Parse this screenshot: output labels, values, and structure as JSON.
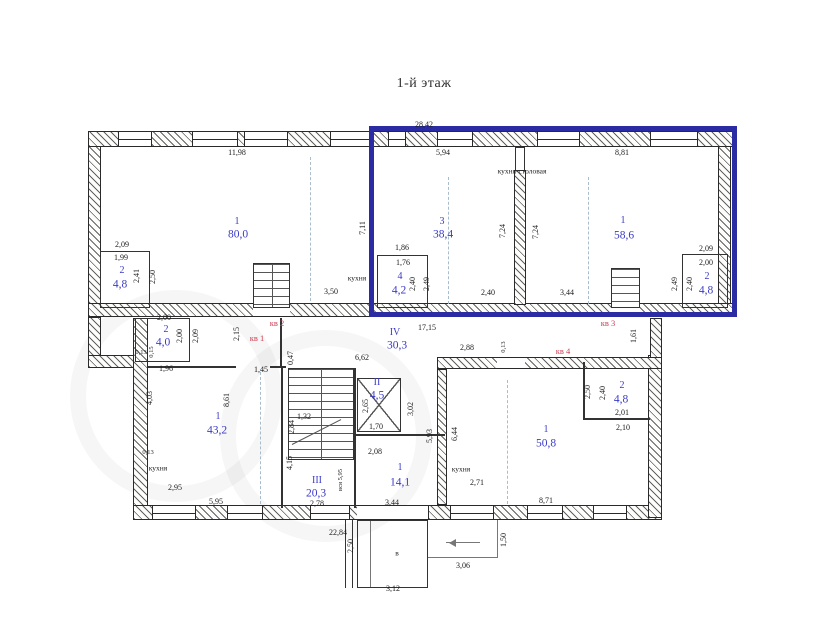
{
  "title": "1-й этаж",
  "colors": {
    "highlight": "#2b2ca3",
    "room_label": "#3a3ac8",
    "apartment_label": "#c94054",
    "dim_text": "#1c1c1c"
  },
  "apartment_tags": [
    "кв 1",
    "кв 2",
    "кв 3",
    "кв 4"
  ],
  "room_notes": [
    "кухня-столовая",
    "кухня",
    "кухня",
    "кухня",
    "в"
  ],
  "labels": [
    {
      "t": "28,42",
      "x": 424,
      "y": 125,
      "c": "d",
      "n": "dim-28-42"
    },
    {
      "t": "11,98",
      "x": 237,
      "y": 153,
      "c": "d",
      "n": "dim-11-98"
    },
    {
      "t": "5,94",
      "x": 443,
      "y": 153,
      "c": "d",
      "n": "dim-5-94"
    },
    {
      "t": "8,81",
      "x": 622,
      "y": 153,
      "c": "d",
      "n": "dim-8-81"
    },
    {
      "t": "кухня-столовая",
      "x": 522,
      "y": 171,
      "c": "note",
      "n": "note-kitchen-dining"
    },
    {
      "t": "7,11",
      "x": 363,
      "y": 228,
      "c": "dv",
      "n": "dim-7-11"
    },
    {
      "t": "7,24",
      "x": 503,
      "y": 231,
      "c": "dv",
      "n": "dim-7-24-a"
    },
    {
      "t": "7,24",
      "x": 536,
      "y": 232,
      "c": "dv",
      "n": "dim-7-24-b"
    },
    {
      "t": "1",
      "x": 237,
      "y": 222,
      "c": "rn",
      "n": "room-num-1-kv1"
    },
    {
      "t": "80,0",
      "x": 238,
      "y": 235,
      "c": "ra",
      "n": "room-area-80-0"
    },
    {
      "t": "3",
      "x": 442,
      "y": 222,
      "c": "rn",
      "n": "room-num-3-kv3"
    },
    {
      "t": "38,4",
      "x": 443,
      "y": 235,
      "c": "ra",
      "n": "room-area-38-4"
    },
    {
      "t": "1",
      "x": 623,
      "y": 221,
      "c": "rn",
      "n": "room-num-1-kv3"
    },
    {
      "t": "58,6",
      "x": 624,
      "y": 236,
      "c": "ra",
      "n": "room-area-58-6"
    },
    {
      "t": "2,09",
      "x": 122,
      "y": 245,
      "c": "d",
      "n": "dim-2-09-ul"
    },
    {
      "t": "1,99",
      "x": 121,
      "y": 258,
      "c": "d",
      "n": "dim-1-99"
    },
    {
      "t": "2",
      "x": 122,
      "y": 271,
      "c": "rn",
      "n": "room-num-2-ul"
    },
    {
      "t": "4,8",
      "x": 120,
      "y": 285,
      "c": "ra",
      "n": "room-area-4-8-ul"
    },
    {
      "t": "2,41",
      "x": 137,
      "y": 276,
      "c": "dv",
      "n": "dim-2-41"
    },
    {
      "t": "2,50",
      "x": 153,
      "y": 277,
      "c": "dv",
      "n": "dim-2-50-ul"
    },
    {
      "t": "кухня",
      "x": 357,
      "y": 278,
      "c": "note",
      "n": "note-kitchen-left"
    },
    {
      "t": "3,50",
      "x": 331,
      "y": 292,
      "c": "d",
      "n": "dim-3-50"
    },
    {
      "t": "1,86",
      "x": 402,
      "y": 248,
      "c": "d",
      "n": "dim-1-86"
    },
    {
      "t": "1,76",
      "x": 403,
      "y": 263,
      "c": "d",
      "n": "dim-1-76"
    },
    {
      "t": "4",
      "x": 400,
      "y": 277,
      "c": "rn",
      "n": "room-num-4"
    },
    {
      "t": "4,2",
      "x": 399,
      "y": 291,
      "c": "ra",
      "n": "room-area-4-2"
    },
    {
      "t": "2,40",
      "x": 413,
      "y": 284,
      "c": "dv",
      "n": "dim-2-40-bl"
    },
    {
      "t": "2,49",
      "x": 427,
      "y": 284,
      "c": "dv",
      "n": "dim-2-49-bl"
    },
    {
      "t": "2,40",
      "x": 488,
      "y": 293,
      "c": "d",
      "n": "dim-2-40-mid"
    },
    {
      "t": "3,44",
      "x": 567,
      "y": 293,
      "c": "d",
      "n": "dim-3-44-up"
    },
    {
      "t": "2,09",
      "x": 706,
      "y": 249,
      "c": "d",
      "n": "dim-2-09-ur"
    },
    {
      "t": "2,00",
      "x": 706,
      "y": 263,
      "c": "d",
      "n": "dim-2-00-ur"
    },
    {
      "t": "2",
      "x": 707,
      "y": 277,
      "c": "rn",
      "n": "room-num-2-ur"
    },
    {
      "t": "4,8",
      "x": 706,
      "y": 291,
      "c": "ra",
      "n": "room-area-4-8-ur"
    },
    {
      "t": "2,49",
      "x": 675,
      "y": 284,
      "c": "dv",
      "n": "dim-2-49-ur"
    },
    {
      "t": "2,40",
      "x": 690,
      "y": 284,
      "c": "dv",
      "n": "dim-2-40-ur"
    },
    {
      "t": "кв 2",
      "x": 277,
      "y": 323,
      "c": "apt",
      "n": "apartment-label-2"
    },
    {
      "t": "кв 1",
      "x": 257,
      "y": 338,
      "c": "apt",
      "n": "apartment-label-1"
    },
    {
      "t": "кв 3",
      "x": 608,
      "y": 323,
      "c": "apt",
      "n": "apartment-label-3"
    },
    {
      "t": "кв 4",
      "x": 563,
      "y": 351,
      "c": "apt",
      "n": "apartment-label-4"
    },
    {
      "t": "2,15",
      "x": 237,
      "y": 334,
      "c": "dv",
      "n": "dim-2-15"
    },
    {
      "t": "2,00",
      "x": 164,
      "y": 318,
      "c": "d",
      "n": "dim-2-00-k1"
    },
    {
      "t": "2",
      "x": 166,
      "y": 330,
      "c": "rn",
      "n": "room-num-2-kv1"
    },
    {
      "t": "4,0",
      "x": 163,
      "y": 343,
      "c": "ra",
      "n": "room-area-4-0"
    },
    {
      "t": "2,00",
      "x": 180,
      "y": 336,
      "c": "dv",
      "n": "dim-2-00-v"
    },
    {
      "t": "2,09",
      "x": 196,
      "y": 336,
      "c": "dv",
      "n": "dim-2-09-v"
    },
    {
      "t": "0,13",
      "x": 141,
      "y": 353,
      "c": "d tiny",
      "n": "dim-0-13-l"
    },
    {
      "t": "0,15",
      "x": 152,
      "y": 352,
      "c": "dv tiny",
      "n": "dim-0-15"
    },
    {
      "t": "1,96",
      "x": 166,
      "y": 369,
      "c": "d",
      "n": "dim-1-96"
    },
    {
      "t": "0,47",
      "x": 291,
      "y": 358,
      "c": "dv",
      "n": "dim-0-47"
    },
    {
      "t": "6,62",
      "x": 362,
      "y": 358,
      "c": "d",
      "n": "dim-6-62"
    },
    {
      "t": "1,45",
      "x": 261,
      "y": 370,
      "c": "d",
      "n": "dim-1-45"
    },
    {
      "t": "IV",
      "x": 395,
      "y": 333,
      "c": "rn",
      "n": "room-num-IV"
    },
    {
      "t": "30,3",
      "x": 397,
      "y": 346,
      "c": "ra",
      "n": "room-area-30-3"
    },
    {
      "t": "17,15",
      "x": 427,
      "y": 328,
      "c": "d",
      "n": "dim-17-15"
    },
    {
      "t": "2,88",
      "x": 467,
      "y": 348,
      "c": "d",
      "n": "dim-2-88"
    },
    {
      "t": "0,13",
      "x": 504,
      "y": 347,
      "c": "dv tiny",
      "n": "dim-0-13-m"
    },
    {
      "t": "1,61",
      "x": 634,
      "y": 336,
      "c": "dv",
      "n": "dim-1-61"
    },
    {
      "t": "4,03",
      "x": 150,
      "y": 398,
      "c": "dv",
      "n": "dim-4-03"
    },
    {
      "t": "8,61",
      "x": 227,
      "y": 400,
      "c": "dv",
      "n": "dim-8-61"
    },
    {
      "t": "1",
      "x": 218,
      "y": 417,
      "c": "rn",
      "n": "room-num-1-kv1-main"
    },
    {
      "t": "43,2",
      "x": 217,
      "y": 431,
      "c": "ra",
      "n": "room-area-43-2"
    },
    {
      "t": "0,13",
      "x": 148,
      "y": 453,
      "c": "d tiny",
      "n": "dim-0-13-b"
    },
    {
      "t": "кухня",
      "x": 158,
      "y": 468,
      "c": "note",
      "n": "note-kitchen-kv1"
    },
    {
      "t": "2,95",
      "x": 175,
      "y": 488,
      "c": "d",
      "n": "dim-2-95"
    },
    {
      "t": "5,95",
      "x": 216,
      "y": 502,
      "c": "d",
      "n": "dim-5-95"
    },
    {
      "t": "1,32",
      "x": 304,
      "y": 417,
      "c": "d",
      "n": "dim-1-32"
    },
    {
      "t": "2,84",
      "x": 292,
      "y": 427,
      "c": "dv",
      "n": "dim-2-84"
    },
    {
      "t": "4,15",
      "x": 290,
      "y": 463,
      "c": "dv",
      "n": "dim-4-15"
    },
    {
      "t": "III",
      "x": 317,
      "y": 481,
      "c": "rn",
      "n": "room-num-III"
    },
    {
      "t": "20,3",
      "x": 316,
      "y": 494,
      "c": "ra",
      "n": "room-area-20-3"
    },
    {
      "t": "2,78",
      "x": 317,
      "y": 504,
      "c": "d",
      "n": "dim-2-78"
    },
    {
      "t": "вся 5,95",
      "x": 341,
      "y": 480,
      "c": "dv tiny",
      "n": "dim-vsya-5-95"
    },
    {
      "t": "II",
      "x": 377,
      "y": 383,
      "c": "rn",
      "n": "room-num-II"
    },
    {
      "t": "4,5",
      "x": 377,
      "y": 396,
      "c": "ra",
      "n": "room-area-4-5"
    },
    {
      "t": "2,65",
      "x": 366,
      "y": 406,
      "c": "dv",
      "n": "dim-2-65"
    },
    {
      "t": "1,70",
      "x": 376,
      "y": 427,
      "c": "d",
      "n": "dim-1-70"
    },
    {
      "t": "3,02",
      "x": 411,
      "y": 409,
      "c": "dv",
      "n": "dim-3-02"
    },
    {
      "t": "5,93",
      "x": 430,
      "y": 436,
      "c": "dv",
      "n": "dim-5-93"
    },
    {
      "t": "6,44",
      "x": 455,
      "y": 434,
      "c": "dv",
      "n": "dim-6-44"
    },
    {
      "t": "2,08",
      "x": 375,
      "y": 452,
      "c": "d",
      "n": "dim-2-08"
    },
    {
      "t": "1",
      "x": 400,
      "y": 468,
      "c": "rn",
      "n": "room-num-1-mid"
    },
    {
      "t": "14,1",
      "x": 400,
      "y": 483,
      "c": "ra",
      "n": "room-area-14-1"
    },
    {
      "t": "3,44",
      "x": 392,
      "y": 503,
      "c": "d",
      "n": "dim-3-44-low"
    },
    {
      "t": "1",
      "x": 546,
      "y": 430,
      "c": "rn",
      "n": "room-num-1-kv4"
    },
    {
      "t": "50,8",
      "x": 546,
      "y": 444,
      "c": "ra",
      "n": "room-area-50-8"
    },
    {
      "t": "кухня",
      "x": 461,
      "y": 469,
      "c": "note",
      "n": "note-kitchen-kv4"
    },
    {
      "t": "2,71",
      "x": 477,
      "y": 483,
      "c": "d",
      "n": "dim-2-71"
    },
    {
      "t": "8,71",
      "x": 546,
      "y": 501,
      "c": "d",
      "n": "dim-8-71"
    },
    {
      "t": "2,50",
      "x": 588,
      "y": 392,
      "c": "dv",
      "n": "dim-2-50-kv4"
    },
    {
      "t": "2,40",
      "x": 603,
      "y": 393,
      "c": "dv",
      "n": "dim-2-40-kv4"
    },
    {
      "t": "2",
      "x": 622,
      "y": 386,
      "c": "rn",
      "n": "room-num-2-kv4"
    },
    {
      "t": "4,8",
      "x": 621,
      "y": 400,
      "c": "ra",
      "n": "room-area-4-8-kv4"
    },
    {
      "t": "2,01",
      "x": 622,
      "y": 413,
      "c": "d",
      "n": "dim-2-01"
    },
    {
      "t": "2,10",
      "x": 623,
      "y": 428,
      "c": "d",
      "n": "dim-2-10"
    },
    {
      "t": "22,84",
      "x": 338,
      "y": 533,
      "c": "d",
      "n": "dim-22-84"
    },
    {
      "t": "2,50",
      "x": 351,
      "y": 546,
      "c": "dv",
      "n": "dim-2-50-porch"
    },
    {
      "t": "в",
      "x": 397,
      "y": 553,
      "c": "note",
      "n": "note-entrance"
    },
    {
      "t": "3,12",
      "x": 393,
      "y": 589,
      "c": "d",
      "n": "dim-3-12"
    },
    {
      "t": "3,06",
      "x": 463,
      "y": 566,
      "c": "d",
      "n": "dim-3-06"
    },
    {
      "t": "1,50",
      "x": 504,
      "y": 540,
      "c": "dv",
      "n": "dim-1-50"
    }
  ]
}
